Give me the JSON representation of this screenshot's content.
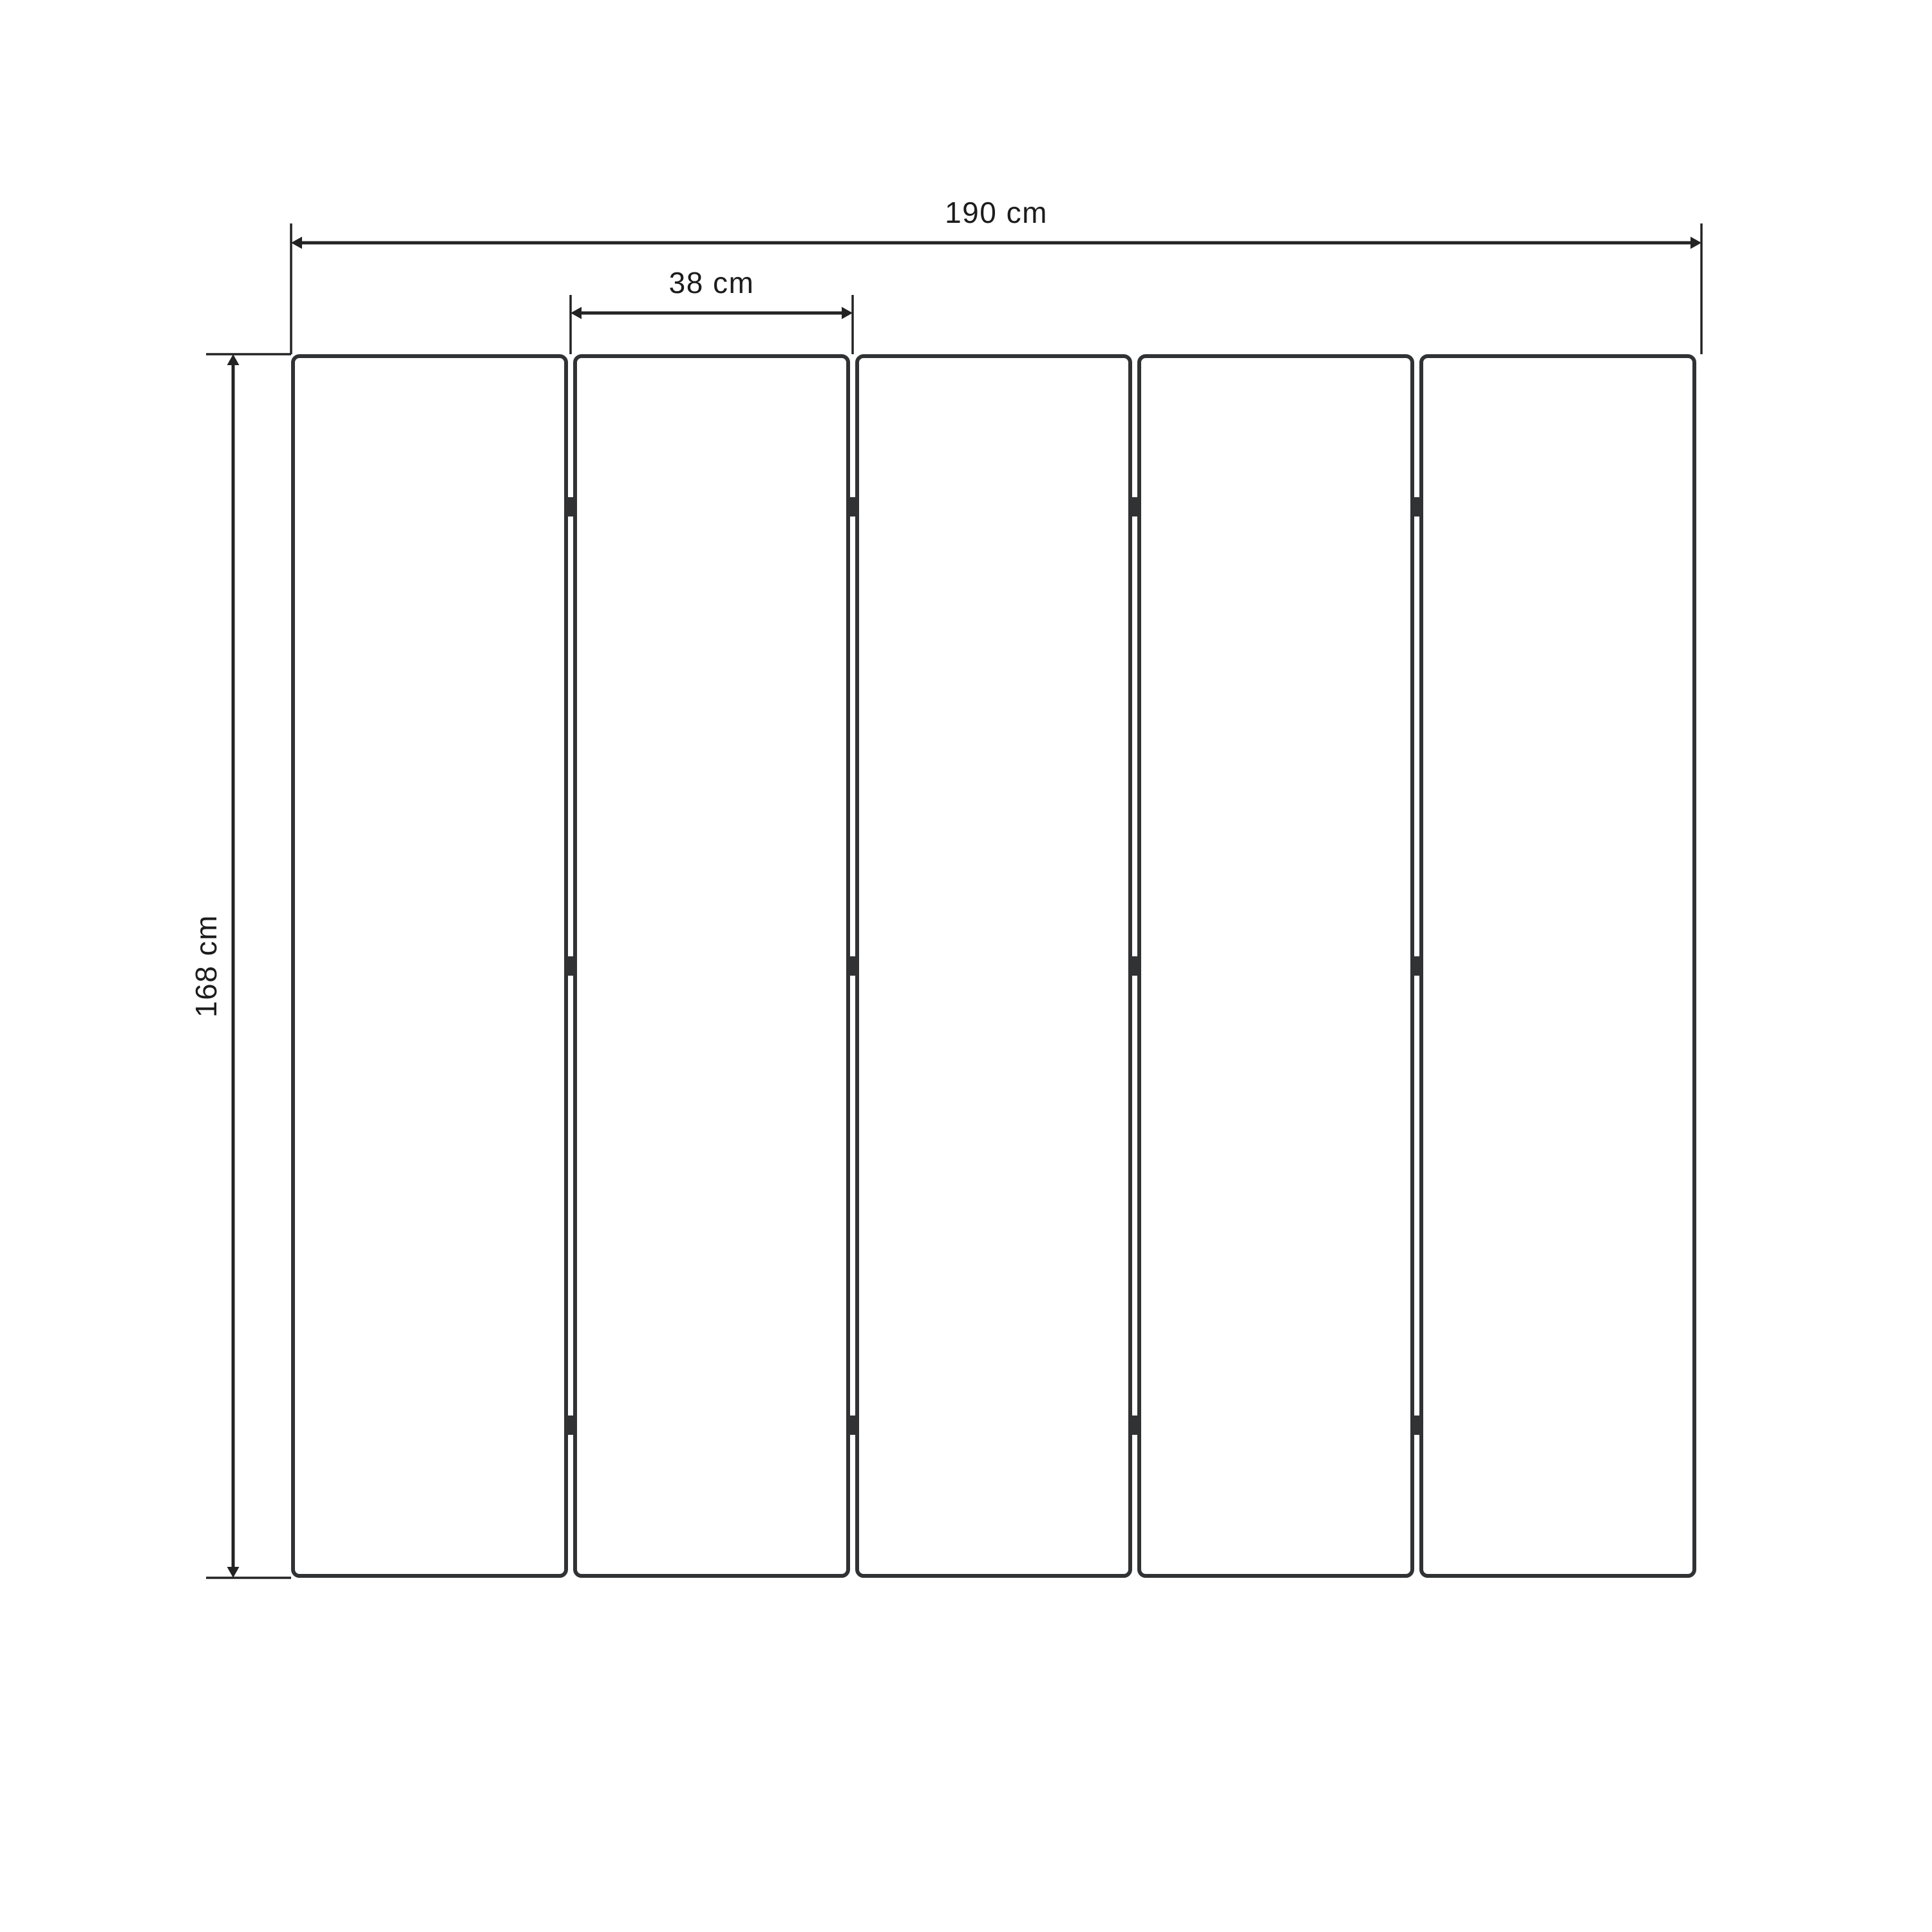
{
  "page": {
    "background": "#ffffff"
  },
  "colors": {
    "panel_stroke": "#303234",
    "dimension": "#232323",
    "text": "#1c1c1c"
  },
  "diagram": {
    "type": "technical-drawing",
    "panel_count": 5,
    "hinge_joints": 4,
    "hinges_per_joint": 3
  },
  "dimensions": {
    "total_width": {
      "label": "190 cm",
      "value_cm": 190
    },
    "panel_width": {
      "label": "38 cm",
      "value_cm": 38
    },
    "height": {
      "label": "168 cm",
      "value_cm": 168
    }
  }
}
